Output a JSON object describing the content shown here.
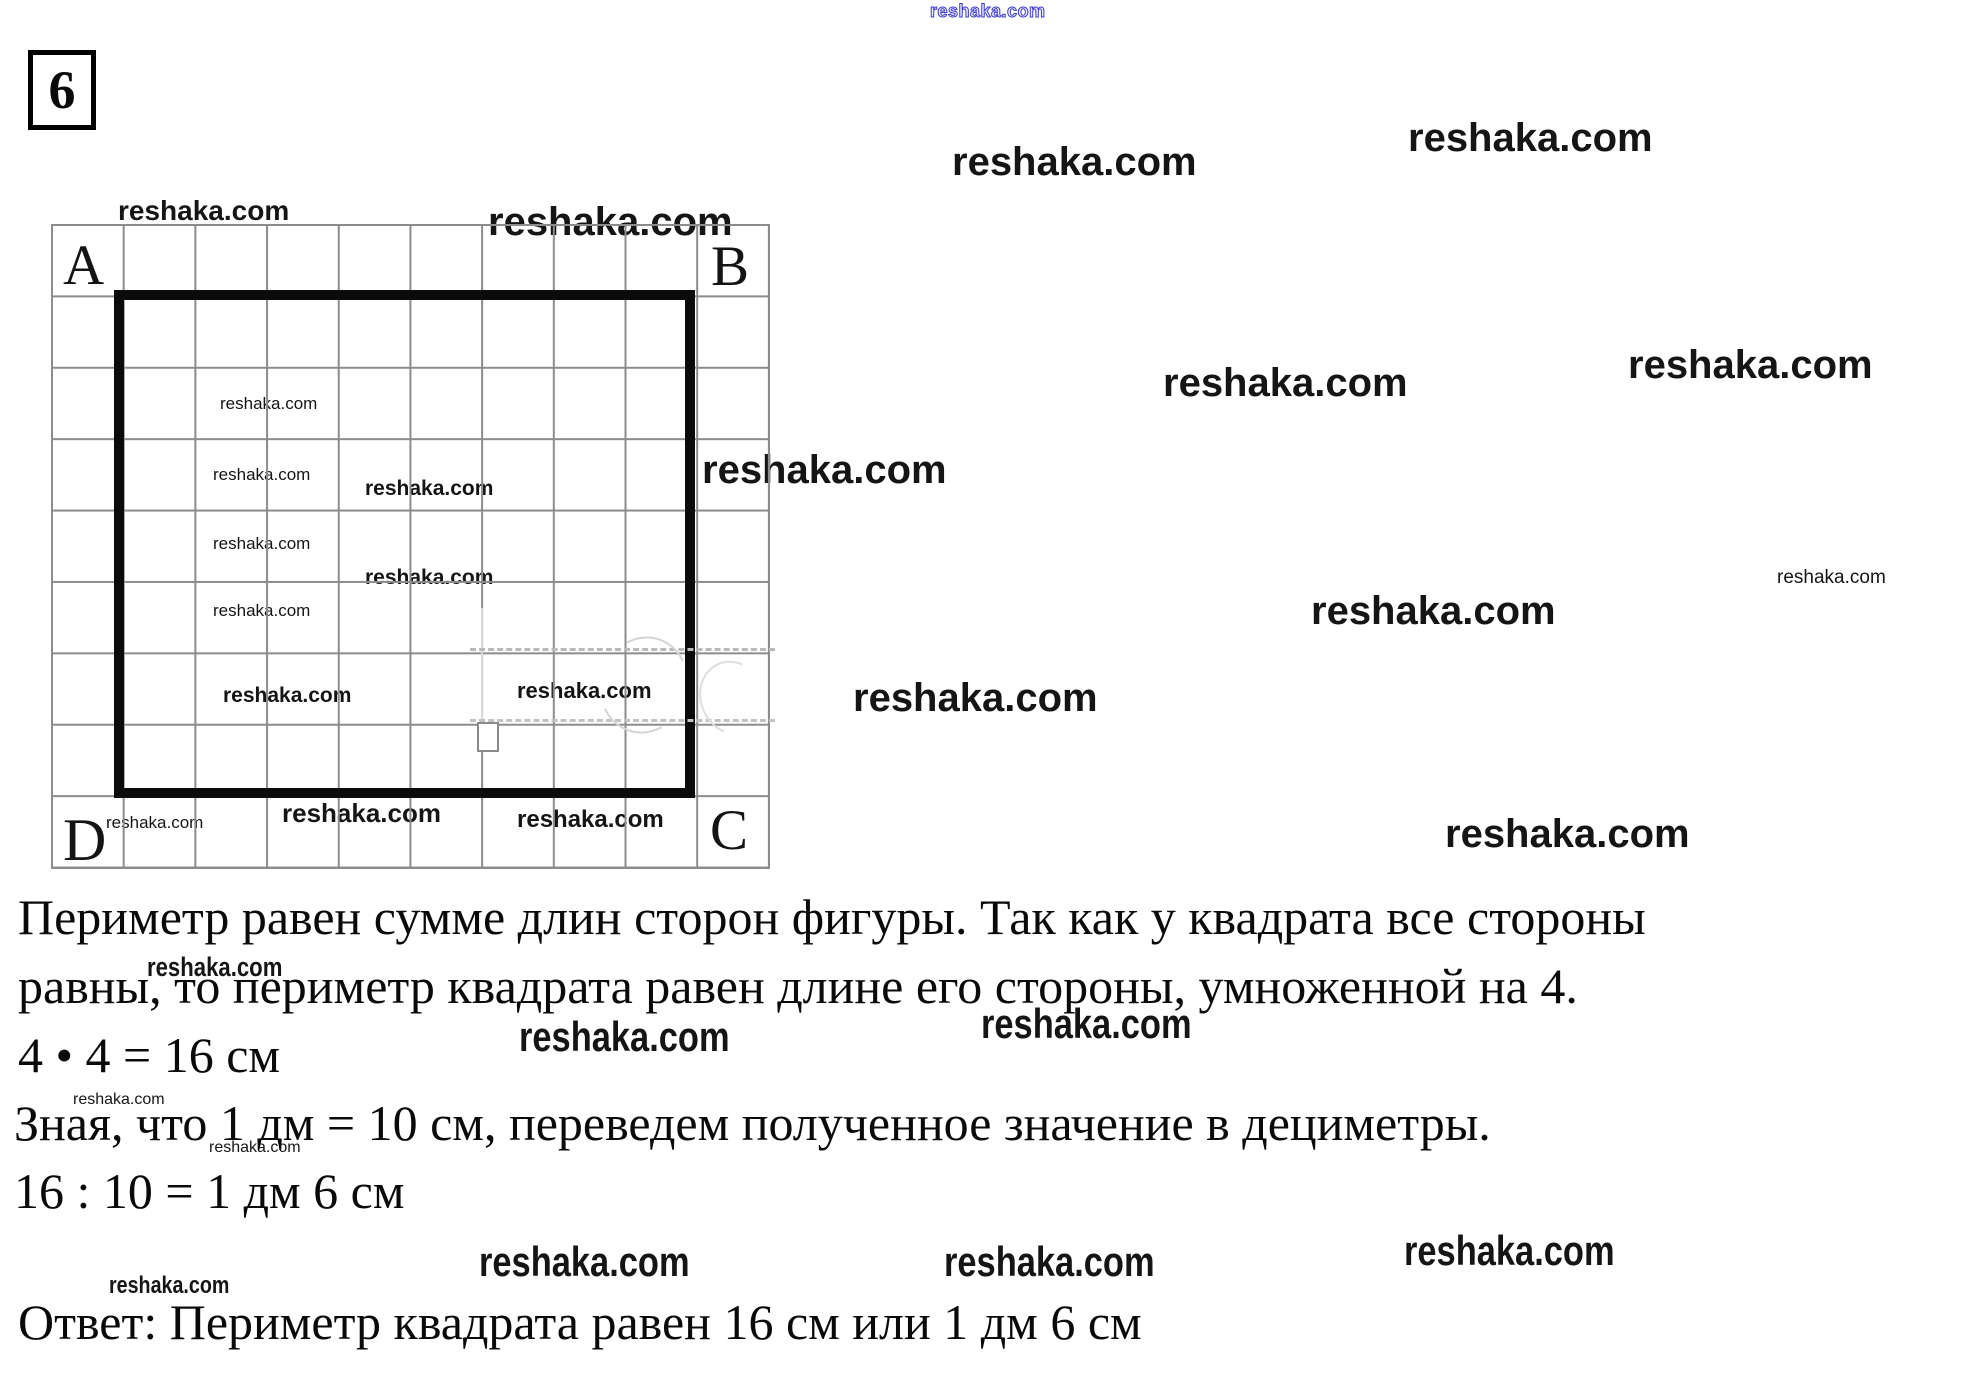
{
  "problem": {
    "number": "6"
  },
  "diagram": {
    "corner_labels": {
      "top_left": "A",
      "top_right": "B",
      "bottom_right": "C",
      "bottom_left": "D"
    },
    "grid": {
      "columns": 10,
      "rows": 9
    },
    "square_cells": {
      "width": 8,
      "height": 7
    }
  },
  "solution": {
    "paragraph1_line1": "Периметр равен сумме длин сторон фигуры. Так как у квадрата все стороны",
    "paragraph1_line2": "равны, то периметр квадрата равен длине его стороны, умноженной на 4.",
    "equation1": "4 • 4 = 16 см",
    "paragraph2": "Зная, что 1 дм = 10 см, переведем полученное значение в дециметры.",
    "equation2": "16 : 10 = 1 дм 6 см",
    "answer": "Ответ: Периметр квадрата равен 16 см или 1 дм 6 см"
  },
  "colors": {
    "ink": "#0a0a0a",
    "grid_line": "#8c8c8c",
    "square_stroke": "#0b0b0b",
    "watermark_blue": "#3a3acc"
  },
  "watermark": {
    "text": "reshaka.com",
    "instances": [
      {
        "x": 930,
        "y": 2,
        "fs": 18,
        "style": "outline"
      },
      {
        "x": 118,
        "y": 197,
        "fs": 28,
        "style": "bold"
      },
      {
        "x": 488,
        "y": 202,
        "fs": 40,
        "style": "bold"
      },
      {
        "x": 220,
        "y": 395,
        "fs": 17,
        "style": "semi"
      },
      {
        "x": 213,
        "y": 466,
        "fs": 17,
        "style": "semi"
      },
      {
        "x": 365,
        "y": 478,
        "fs": 21,
        "style": "bold"
      },
      {
        "x": 213,
        "y": 535,
        "fs": 17,
        "style": "semi"
      },
      {
        "x": 365,
        "y": 567,
        "fs": 21,
        "style": "bold"
      },
      {
        "x": 213,
        "y": 602,
        "fs": 17,
        "style": "semi"
      },
      {
        "x": 223,
        "y": 685,
        "fs": 21,
        "style": "bold"
      },
      {
        "x": 517,
        "y": 680,
        "fs": 22,
        "style": "bold"
      },
      {
        "x": 282,
        "y": 800,
        "fs": 26,
        "style": "bold"
      },
      {
        "x": 517,
        "y": 808,
        "fs": 24,
        "style": "bold"
      },
      {
        "x": 106,
        "y": 814,
        "fs": 17,
        "style": "semi"
      },
      {
        "x": 952,
        "y": 142,
        "fs": 40,
        "style": "bold"
      },
      {
        "x": 1408,
        "y": 118,
        "fs": 40,
        "style": "bold"
      },
      {
        "x": 1163,
        "y": 363,
        "fs": 40,
        "style": "bold"
      },
      {
        "x": 1628,
        "y": 345,
        "fs": 40,
        "style": "bold"
      },
      {
        "x": 702,
        "y": 450,
        "fs": 40,
        "style": "bold"
      },
      {
        "x": 1311,
        "y": 591,
        "fs": 40,
        "style": "bold"
      },
      {
        "x": 1777,
        "y": 568,
        "fs": 19,
        "style": "semi"
      },
      {
        "x": 853,
        "y": 678,
        "fs": 40,
        "style": "bold"
      },
      {
        "x": 1445,
        "y": 814,
        "fs": 40,
        "style": "bold"
      },
      {
        "x": 147,
        "y": 954,
        "fs": 27,
        "style": "narrow"
      },
      {
        "x": 519,
        "y": 1016,
        "fs": 42,
        "style": "narrow"
      },
      {
        "x": 981,
        "y": 1003,
        "fs": 42,
        "style": "narrow"
      },
      {
        "x": 73,
        "y": 1092,
        "fs": 16,
        "style": "semi"
      },
      {
        "x": 209,
        "y": 1140,
        "fs": 16,
        "style": "semi"
      },
      {
        "x": 479,
        "y": 1241,
        "fs": 42,
        "style": "narrow"
      },
      {
        "x": 944,
        "y": 1241,
        "fs": 42,
        "style": "narrow"
      },
      {
        "x": 1404,
        "y": 1230,
        "fs": 42,
        "style": "narrow"
      },
      {
        "x": 109,
        "y": 1274,
        "fs": 24,
        "style": "narrow"
      }
    ]
  }
}
